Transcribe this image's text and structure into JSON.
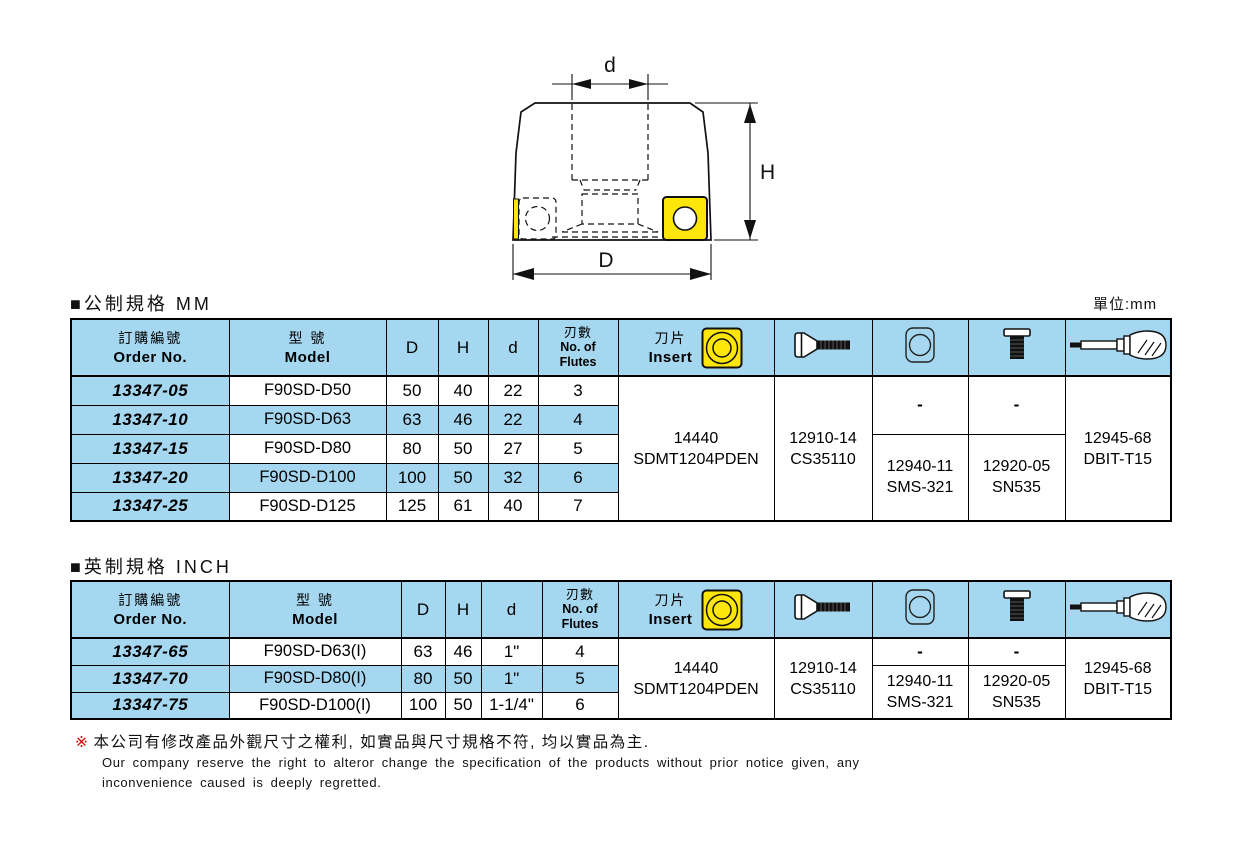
{
  "page": {
    "metric_title": "■公制規格 MM",
    "inch_title": "■英制規格 INCH",
    "unit_label": "單位:mm"
  },
  "diagram": {
    "dim_top": "d",
    "dim_right": "H",
    "dim_bottom": "D",
    "insert_color": "#ffe60a"
  },
  "headers": {
    "order_cn": "訂購編號",
    "order_en": "Order No.",
    "model_cn": "型 號",
    "model_en": "Model",
    "col_D": "D",
    "col_H": "H",
    "col_d": "d",
    "flutes_cn": "刃數",
    "flutes_en1": "No. of",
    "flutes_en2": "Flutes",
    "insert_cn": "刀片",
    "insert_en": "Insert"
  },
  "metric": {
    "rows": [
      {
        "order": "13347-05",
        "model": "F90SD-D50",
        "D": "50",
        "H": "40",
        "d": "22",
        "flutes": "3"
      },
      {
        "order": "13347-10",
        "model": "F90SD-D63",
        "D": "63",
        "H": "46",
        "d": "22",
        "flutes": "4"
      },
      {
        "order": "13347-15",
        "model": "F90SD-D80",
        "D": "80",
        "H": "50",
        "d": "27",
        "flutes": "5"
      },
      {
        "order": "13347-20",
        "model": "F90SD-D100",
        "D": "100",
        "H": "50",
        "d": "32",
        "flutes": "6"
      },
      {
        "order": "13347-25",
        "model": "F90SD-D125",
        "D": "125",
        "H": "61",
        "d": "40",
        "flutes": "7"
      }
    ],
    "insert_no": "14440",
    "insert_model": "SDMT1204PDEN",
    "screw_no": "12910-14",
    "screw_model": "CS35110",
    "shim_blank": "-",
    "shim_no": "12940-11",
    "shim_model": "SMS-321",
    "clamp_blank": "-",
    "clamp_no": "12920-05",
    "clamp_model": "SN535",
    "wrench_no": "12945-68",
    "wrench_model": "DBIT-T15"
  },
  "inch": {
    "rows": [
      {
        "order": "13347-65",
        "model": "F90SD-D63(I)",
        "D": "63",
        "H": "46",
        "d": "1\"",
        "flutes": "4"
      },
      {
        "order": "13347-70",
        "model": "F90SD-D80(I)",
        "D": "80",
        "H": "50",
        "d": "1\"",
        "flutes": "5"
      },
      {
        "order": "13347-75",
        "model": "F90SD-D100(I)",
        "D": "100",
        "H": "50",
        "d": "1-1/4\"",
        "flutes": "6"
      }
    ],
    "insert_no": "14440",
    "insert_model": "SDMT1204PDEN",
    "screw_no": "12910-14",
    "screw_model": "CS35110",
    "shim_blank": "-",
    "shim_no": "12940-11",
    "shim_model": "SMS-321",
    "clamp_blank": "-",
    "clamp_no": "12920-05",
    "clamp_model": "SN535",
    "wrench_no": "12945-68",
    "wrench_model": "DBIT-T15"
  },
  "footnote": {
    "marker": "※",
    "cn": "本公司有修改產品外觀尺寸之權利, 如實品與尺寸規格不符, 均以實品為主.",
    "en1": "Our company reserve the right to alteror change the specification of the products without prior notice given, any",
    "en2": "inconvenience caused is deeply regretted."
  }
}
